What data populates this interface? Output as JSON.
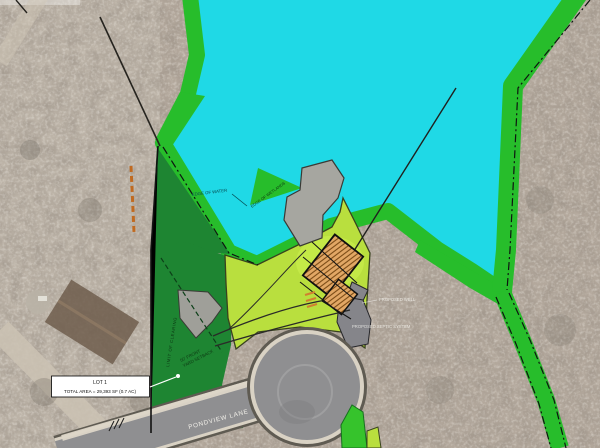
{
  "labels": {
    "lot_box": {
      "line1": "LOT 1",
      "line2": "TOTAL AREA = 29,393 SF (0.7 AC)"
    },
    "street": "PONDVIEW LANE",
    "setback": {
      "line1": "50' FRONT",
      "line2": "YARD SETBACK"
    },
    "clearing": "LIMIT OF CLEARING",
    "water_edge": "EDGE OF WATER",
    "wetland_edge": "EDGE OF WETLANDS",
    "well": "PROPOSED WELL",
    "septic": "PROPOSED SEPTIC SYSTEM"
  },
  "colors": {
    "water": "#1fd9e6",
    "shore_green": "#27bd2b",
    "buffer_green": "#1e8532",
    "lot_green": "#b9df3e",
    "road_gray": "#8f8f91",
    "road_edge": "#d9d2c4",
    "building_fill": "#e2a765",
    "building_hatch": "#7a4a15",
    "aerial_base": "#b3a89c"
  }
}
